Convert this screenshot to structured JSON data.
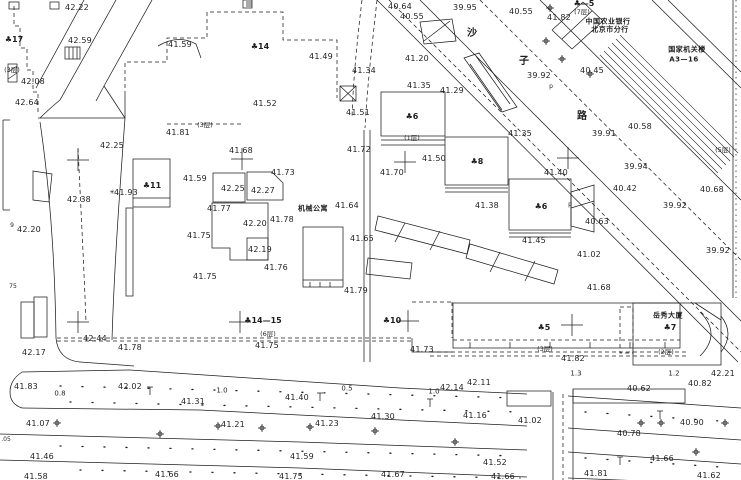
{
  "canvas": {
    "width": 741,
    "height": 480,
    "background": "#ffffff",
    "ink": "#1f1f1f"
  },
  "labels": [
    {
      "t": "42.22",
      "x": 77,
      "y": 8,
      "k": "e"
    },
    {
      "t": "42.59",
      "x": 80,
      "y": 41,
      "k": "e"
    },
    {
      "t": "♣17",
      "x": 14,
      "y": 40,
      "k": "b"
    },
    {
      "t": "(3层)",
      "x": 12,
      "y": 70,
      "k": "f"
    },
    {
      "t": "42.08",
      "x": 33,
      "y": 82,
      "k": "e"
    },
    {
      "t": "42.64",
      "x": 27,
      "y": 103,
      "k": "e"
    },
    {
      "t": "41.59",
      "x": 180,
      "y": 45,
      "k": "e"
    },
    {
      "t": "41.81",
      "x": 178,
      "y": 133,
      "k": "e"
    },
    {
      "t": "(3层)",
      "x": 205,
      "y": 125,
      "k": "f"
    },
    {
      "t": "42.25",
      "x": 112,
      "y": 146,
      "k": "e"
    },
    {
      "t": "42.38",
      "x": 79,
      "y": 200,
      "k": "e"
    },
    {
      "t": "✳",
      "x": 112,
      "y": 193,
      "k": "m"
    },
    {
      "t": "41.93",
      "x": 126,
      "y": 193,
      "k": "e"
    },
    {
      "t": "♣11",
      "x": 152,
      "y": 186,
      "k": "b"
    },
    {
      "t": "42.20",
      "x": 29,
      "y": 230,
      "k": "e"
    },
    {
      "t": "9",
      "x": 12,
      "y": 226,
      "k": "m"
    },
    {
      "t": "75",
      "x": 13,
      "y": 287,
      "k": "m"
    },
    {
      "t": "42.17",
      "x": 34,
      "y": 353,
      "k": "e"
    },
    {
      "t": "42.44",
      "x": 95,
      "y": 339,
      "k": "e"
    },
    {
      "t": "41.78",
      "x": 130,
      "y": 348,
      "k": "e"
    },
    {
      "t": "41.83",
      "x": 26,
      "y": 387,
      "k": "e"
    },
    {
      "t": "0.8",
      "x": 60,
      "y": 394,
      "k": "d"
    },
    {
      "t": "42.02",
      "x": 130,
      "y": 387,
      "k": "e"
    },
    {
      "t": "41.07",
      "x": 38,
      "y": 424,
      "k": "e"
    },
    {
      "t": ".05",
      "x": 6,
      "y": 440,
      "k": "m"
    },
    {
      "t": "41.46",
      "x": 42,
      "y": 457,
      "k": "e"
    },
    {
      "t": "41.58",
      "x": 36,
      "y": 477,
      "k": "e"
    },
    {
      "t": "41.66",
      "x": 167,
      "y": 475,
      "k": "e"
    },
    {
      "t": "♣14",
      "x": 260,
      "y": 47,
      "k": "b"
    },
    {
      "t": "41.52",
      "x": 265,
      "y": 104,
      "k": "e"
    },
    {
      "t": "41.49",
      "x": 321,
      "y": 57,
      "k": "e"
    },
    {
      "t": "41.51",
      "x": 358,
      "y": 113,
      "k": "e"
    },
    {
      "t": "41.34",
      "x": 364,
      "y": 71,
      "k": "e"
    },
    {
      "t": "40.64",
      "x": 400,
      "y": 7,
      "k": "e"
    },
    {
      "t": "40.55",
      "x": 412,
      "y": 17,
      "k": "e"
    },
    {
      "t": "39.95",
      "x": 465,
      "y": 8,
      "k": "e"
    },
    {
      "t": "40.55",
      "x": 521,
      "y": 12,
      "k": "e"
    },
    {
      "t": "41.20",
      "x": 417,
      "y": 59,
      "k": "e"
    },
    {
      "t": "41.35",
      "x": 419,
      "y": 86,
      "k": "e"
    },
    {
      "t": "41.29",
      "x": 452,
      "y": 91,
      "k": "e"
    },
    {
      "t": "沙",
      "x": 472,
      "y": 34,
      "k": "s"
    },
    {
      "t": "子",
      "x": 524,
      "y": 62,
      "k": "s"
    },
    {
      "t": "路",
      "x": 582,
      "y": 117,
      "k": "s"
    },
    {
      "t": "p",
      "x": 551,
      "y": 87,
      "k": "m"
    },
    {
      "t": "39.92",
      "x": 539,
      "y": 76,
      "k": "e"
    },
    {
      "t": "♣—5",
      "x": 584,
      "y": 4,
      "k": "b"
    },
    {
      "t": "(7层)",
      "x": 582,
      "y": 12,
      "k": "f"
    },
    {
      "t": "41.82",
      "x": 559,
      "y": 18,
      "k": "e"
    },
    {
      "t": "中国农业银行",
      "x": 608,
      "y": 22,
      "k": "c"
    },
    {
      "t": "北京市分行",
      "x": 610,
      "y": 30,
      "k": "c"
    },
    {
      "t": "国家机关楼",
      "x": 687,
      "y": 50,
      "k": "c"
    },
    {
      "t": "A3—16",
      "x": 684,
      "y": 60,
      "k": "c"
    },
    {
      "t": "40.45",
      "x": 592,
      "y": 71,
      "k": "e"
    },
    {
      "t": "40.58",
      "x": 640,
      "y": 127,
      "k": "e"
    },
    {
      "t": "39.91",
      "x": 604,
      "y": 134,
      "k": "e"
    },
    {
      "t": "39.94",
      "x": 636,
      "y": 167,
      "k": "e"
    },
    {
      "t": "40.42",
      "x": 625,
      "y": 189,
      "k": "e"
    },
    {
      "t": "(5层)",
      "x": 723,
      "y": 150,
      "k": "f"
    },
    {
      "t": "40.68",
      "x": 712,
      "y": 190,
      "k": "e"
    },
    {
      "t": "39.92",
      "x": 675,
      "y": 206,
      "k": "e"
    },
    {
      "t": "40.63",
      "x": 597,
      "y": 222,
      "k": "e"
    },
    {
      "t": "39.92",
      "x": 718,
      "y": 251,
      "k": "e"
    },
    {
      "t": "41.02",
      "x": 589,
      "y": 255,
      "k": "e"
    },
    {
      "t": "41.68",
      "x": 599,
      "y": 288,
      "k": "e"
    },
    {
      "t": "♣6",
      "x": 412,
      "y": 117,
      "k": "b"
    },
    {
      "t": "(1层)",
      "x": 412,
      "y": 138,
      "k": "f"
    },
    {
      "t": "41.50",
      "x": 434,
      "y": 159,
      "k": "e"
    },
    {
      "t": "♣8",
      "x": 477,
      "y": 162,
      "k": "b"
    },
    {
      "t": "41.35",
      "x": 520,
      "y": 134,
      "k": "e"
    },
    {
      "t": "41.70",
      "x": 392,
      "y": 173,
      "k": "e"
    },
    {
      "t": "41.40",
      "x": 556,
      "y": 173,
      "k": "e"
    },
    {
      "t": "41.38",
      "x": 487,
      "y": 206,
      "k": "e"
    },
    {
      "t": "♣6",
      "x": 541,
      "y": 207,
      "k": "b"
    },
    {
      "t": "41.45",
      "x": 534,
      "y": 241,
      "k": "e"
    },
    {
      "t": "41.64",
      "x": 347,
      "y": 206,
      "k": "e"
    },
    {
      "t": "机械公寓",
      "x": 313,
      "y": 209,
      "k": "c"
    },
    {
      "t": "41.65",
      "x": 362,
      "y": 239,
      "k": "e"
    },
    {
      "t": "41.72",
      "x": 359,
      "y": 150,
      "k": "e"
    },
    {
      "t": "41.79",
      "x": 356,
      "y": 291,
      "k": "e"
    },
    {
      "t": "41.68",
      "x": 241,
      "y": 151,
      "k": "e"
    },
    {
      "t": "41.73",
      "x": 283,
      "y": 173,
      "k": "e"
    },
    {
      "t": "41.59",
      "x": 195,
      "y": 179,
      "k": "e"
    },
    {
      "t": "42.25",
      "x": 233,
      "y": 189,
      "k": "e"
    },
    {
      "t": "42.27",
      "x": 263,
      "y": 191,
      "k": "e"
    },
    {
      "t": "41.77",
      "x": 219,
      "y": 209,
      "k": "e"
    },
    {
      "t": "42.20",
      "x": 255,
      "y": 224,
      "k": "e"
    },
    {
      "t": "41.78",
      "x": 282,
      "y": 220,
      "k": "e"
    },
    {
      "t": "41.75",
      "x": 199,
      "y": 236,
      "k": "e"
    },
    {
      "t": "42.19",
      "x": 260,
      "y": 250,
      "k": "e"
    },
    {
      "t": "41.76",
      "x": 276,
      "y": 268,
      "k": "e"
    },
    {
      "t": "41.75",
      "x": 205,
      "y": 277,
      "k": "e"
    },
    {
      "t": "♣14—15",
      "x": 263,
      "y": 321,
      "k": "b"
    },
    {
      "t": "(6层)",
      "x": 268,
      "y": 334,
      "k": "f"
    },
    {
      "t": "41.75",
      "x": 267,
      "y": 346,
      "k": "e"
    },
    {
      "t": "♣10",
      "x": 392,
      "y": 321,
      "k": "b"
    },
    {
      "t": "♣5",
      "x": 544,
      "y": 328,
      "k": "b"
    },
    {
      "t": "(3层)",
      "x": 545,
      "y": 349,
      "k": "f"
    },
    {
      "t": "41.82",
      "x": 573,
      "y": 359,
      "k": "e"
    },
    {
      "t": "41.73",
      "x": 422,
      "y": 350,
      "k": "e"
    },
    {
      "t": "1.3",
      "x": 576,
      "y": 374,
      "k": "d"
    },
    {
      "t": "42.11",
      "x": 479,
      "y": 383,
      "k": "e"
    },
    {
      "t": "42.14",
      "x": 452,
      "y": 388,
      "k": "e"
    },
    {
      "t": "1.0",
      "x": 434,
      "y": 392,
      "k": "d"
    },
    {
      "t": "41.16",
      "x": 475,
      "y": 416,
      "k": "e"
    },
    {
      "t": "41.02",
      "x": 530,
      "y": 421,
      "k": "e"
    },
    {
      "t": "40.82",
      "x": 700,
      "y": 384,
      "k": "e"
    },
    {
      "t": "42.21",
      "x": 723,
      "y": 374,
      "k": "e"
    },
    {
      "t": "岳秀大厦",
      "x": 668,
      "y": 316,
      "k": "c"
    },
    {
      "t": "♣7",
      "x": 670,
      "y": 328,
      "k": "b"
    },
    {
      "t": "(2层)",
      "x": 666,
      "y": 352,
      "k": "f"
    },
    {
      "t": "1.2",
      "x": 674,
      "y": 374,
      "k": "d"
    },
    {
      "t": "40.62",
      "x": 639,
      "y": 389,
      "k": "e"
    },
    {
      "t": "40.90",
      "x": 692,
      "y": 423,
      "k": "e"
    },
    {
      "t": "40.78",
      "x": 629,
      "y": 434,
      "k": "e"
    },
    {
      "t": "41.66",
      "x": 662,
      "y": 459,
      "k": "e"
    },
    {
      "t": "41.81",
      "x": 596,
      "y": 474,
      "k": "e"
    },
    {
      "t": "41.62",
      "x": 709,
      "y": 476,
      "k": "e"
    },
    {
      "t": "41.52",
      "x": 495,
      "y": 463,
      "k": "e"
    },
    {
      "t": "41.66",
      "x": 503,
      "y": 477,
      "k": "e"
    },
    {
      "t": "41.67",
      "x": 393,
      "y": 475,
      "k": "e"
    },
    {
      "t": "41.59",
      "x": 302,
      "y": 457,
      "k": "e"
    },
    {
      "t": "41.75",
      "x": 291,
      "y": 477,
      "k": "e"
    },
    {
      "t": "1.0",
      "x": 222,
      "y": 391,
      "k": "d"
    },
    {
      "t": "0.5",
      "x": 347,
      "y": 389,
      "k": "d"
    },
    {
      "t": "41.31",
      "x": 193,
      "y": 402,
      "k": "e"
    },
    {
      "t": "41.40",
      "x": 297,
      "y": 398,
      "k": "e"
    },
    {
      "t": "41.21",
      "x": 233,
      "y": 425,
      "k": "e"
    },
    {
      "t": "41.23",
      "x": 327,
      "y": 424,
      "k": "e"
    },
    {
      "t": "41.30",
      "x": 383,
      "y": 417,
      "k": "e"
    },
    {
      "t": "p",
      "x": 570,
      "y": 205,
      "k": "m"
    }
  ],
  "survey_crosses": [
    [
      78,
      160
    ],
    [
      242,
      159
    ],
    [
      405,
      162
    ],
    [
      568,
      158
    ],
    [
      78,
      322
    ],
    [
      240,
      322
    ],
    [
      408,
      321
    ],
    [
      572,
      325
    ]
  ],
  "tree_symbols": [
    [
      550,
      8
    ],
    [
      546,
      41
    ],
    [
      562,
      59
    ],
    [
      590,
      74
    ],
    [
      57,
      423
    ],
    [
      160,
      434
    ],
    [
      218,
      426
    ],
    [
      262,
      428
    ],
    [
      310,
      427
    ],
    [
      375,
      431
    ],
    [
      455,
      442
    ],
    [
      641,
      423
    ],
    [
      661,
      423
    ],
    [
      696,
      452
    ],
    [
      725,
      423
    ]
  ],
  "lamp_symbols": [
    [
      150,
      391
    ],
    [
      320,
      397
    ],
    [
      430,
      403
    ],
    [
      660,
      415
    ],
    [
      620,
      461
    ]
  ]
}
